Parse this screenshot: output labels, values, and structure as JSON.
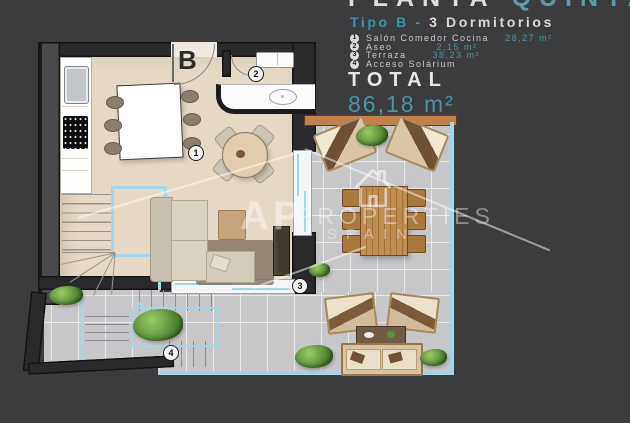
{
  "header": {
    "title_primary": "PLANTA",
    "title_secondary": "QUINTA",
    "type_label": "Tipo B - ",
    "type_rooms": "3 Dormitorios"
  },
  "legend": [
    {
      "num": "1",
      "label": "Salón Comedor Cocina",
      "area": "28,27 m²"
    },
    {
      "num": "2",
      "label": "Aseo",
      "area": "2,15 m²"
    },
    {
      "num": "3",
      "label": "Terraza",
      "area": "38,23 m²"
    },
    {
      "num": "4",
      "label": "Acceso Solárium",
      "area": ""
    }
  ],
  "total": {
    "label": "TOTAL",
    "value": "86,18 m²"
  },
  "plan": {
    "unit_letter": "B",
    "markers": [
      {
        "area": "salon-comedor-cocina",
        "num": "1"
      },
      {
        "area": "aseo",
        "num": "2"
      },
      {
        "area": "terraza",
        "num": "3"
      },
      {
        "area": "acceso-solarium",
        "num": "4"
      }
    ]
  },
  "watermark": {
    "initials": "AP",
    "line1": "PROPERTIES",
    "line2": "SPAIN"
  },
  "colors": {
    "accent_teal": "#4c93a7",
    "background": "#3c3c3e",
    "floor_beige": "#e6d8c6",
    "terrace_gray": "#c7c7ca",
    "outline_blue": "#a6d4e9",
    "railing_orange": "#bf8049",
    "wall_dark": "#2a2a2c"
  }
}
